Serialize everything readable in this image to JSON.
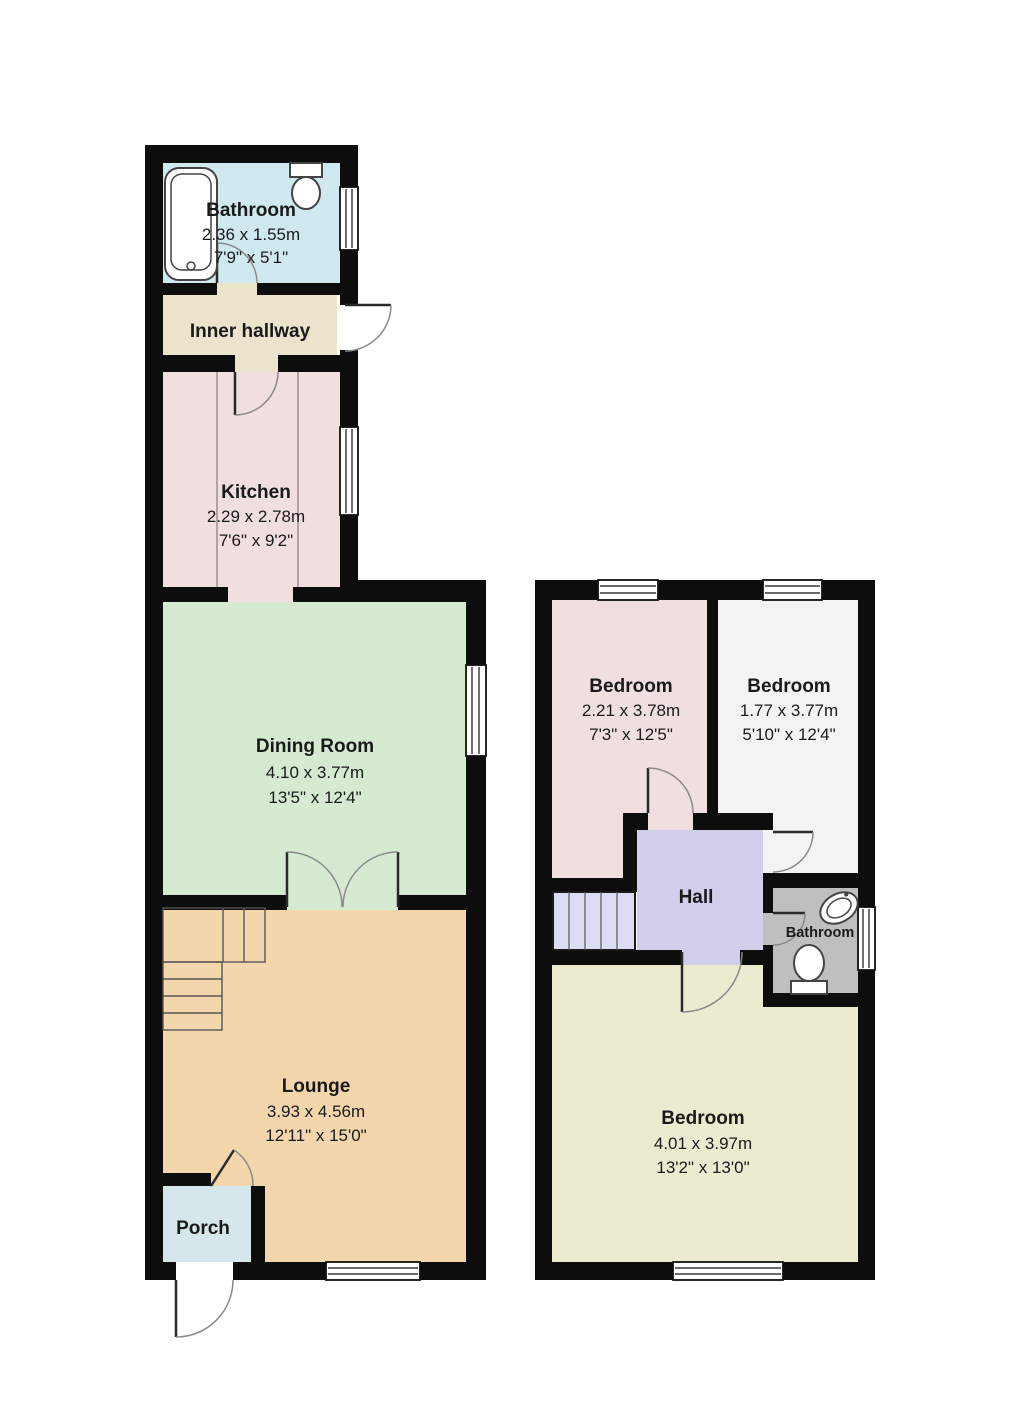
{
  "title": "Two storey house floorplan",
  "colors": {
    "walls": "#0d0d0d",
    "ground": {
      "bathroom": "#cfe9ef",
      "inner_hallway": "#ece3cd",
      "kitchen": "#f1dede",
      "dining": "#d5ead1",
      "lounge": "#f3d6ac",
      "porch": "#d5e7eb"
    },
    "first": {
      "bedroom1": "#f1dede",
      "bedroom2": "#f3f3f3",
      "hall": "#cfcfeb",
      "stairs": "#dcdcf2",
      "bathroom": "#bfbfbf",
      "bedroom3": "#ebebd0"
    },
    "exterior": "#ffffff"
  },
  "floors": [
    {
      "name": "ground",
      "rooms": [
        {
          "id": "bathroom",
          "name": "Bathroom",
          "metric": "2.36 x 1.55m",
          "imperial": "7'9\" x 5'1\""
        },
        {
          "id": "inner-hallway",
          "name": "Inner hallway",
          "metric": "",
          "imperial": ""
        },
        {
          "id": "kitchen",
          "name": "Kitchen",
          "metric": "2.29 x 2.78m",
          "imperial": "7'6\" x 9'2\""
        },
        {
          "id": "dining-room",
          "name": "Dining Room",
          "metric": "4.10 x 3.77m",
          "imperial": "13'5\" x 12'4\""
        },
        {
          "id": "lounge",
          "name": "Lounge",
          "metric": "3.93 x 4.56m",
          "imperial": "12'11\" x 15'0\""
        },
        {
          "id": "porch",
          "name": "Porch",
          "metric": "",
          "imperial": ""
        }
      ]
    },
    {
      "name": "first",
      "rooms": [
        {
          "id": "bedroom-1",
          "name": "Bedroom",
          "metric": "2.21 x 3.78m",
          "imperial": "7'3\" x 12'5\""
        },
        {
          "id": "bedroom-2",
          "name": "Bedroom",
          "metric": "1.77 x 3.77m",
          "imperial": "5'10\" x 12'4\""
        },
        {
          "id": "hall",
          "name": "Hall",
          "metric": "",
          "imperial": ""
        },
        {
          "id": "bathroom",
          "name": "Bathroom",
          "metric": "",
          "imperial": ""
        },
        {
          "id": "bedroom-3",
          "name": "Bedroom",
          "metric": "4.01 x 3.97m",
          "imperial": "13'2\" x 13'0\""
        }
      ]
    }
  ]
}
